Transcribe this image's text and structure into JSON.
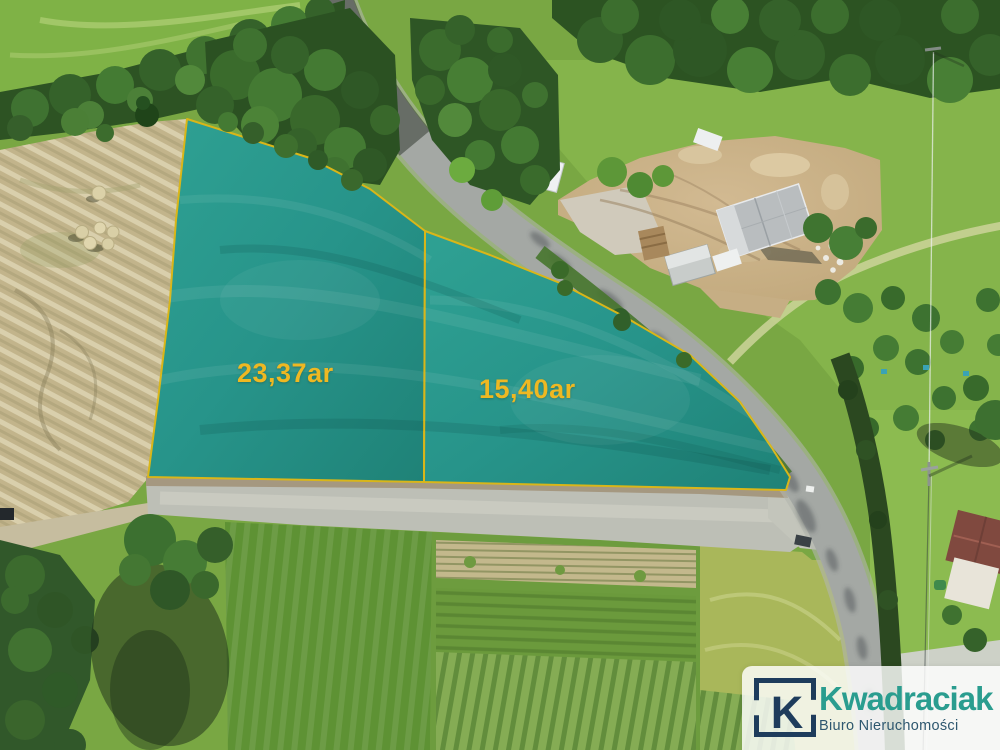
{
  "parcels": {
    "left": {
      "area_label": "23,37ar"
    },
    "right": {
      "area_label": "15,40ar"
    },
    "overlay_color": "#2a9489",
    "border_color": "#d9b619",
    "label_color": "#eeb822"
  },
  "watermark": {
    "monogram": "K",
    "brand": "Kwadraciak",
    "subtitle": "Biuro Nieruchomości",
    "brand_color": "#2a9d8f",
    "monogram_color": "#1e3c5c",
    "subtitle_color": "#2e576f"
  }
}
